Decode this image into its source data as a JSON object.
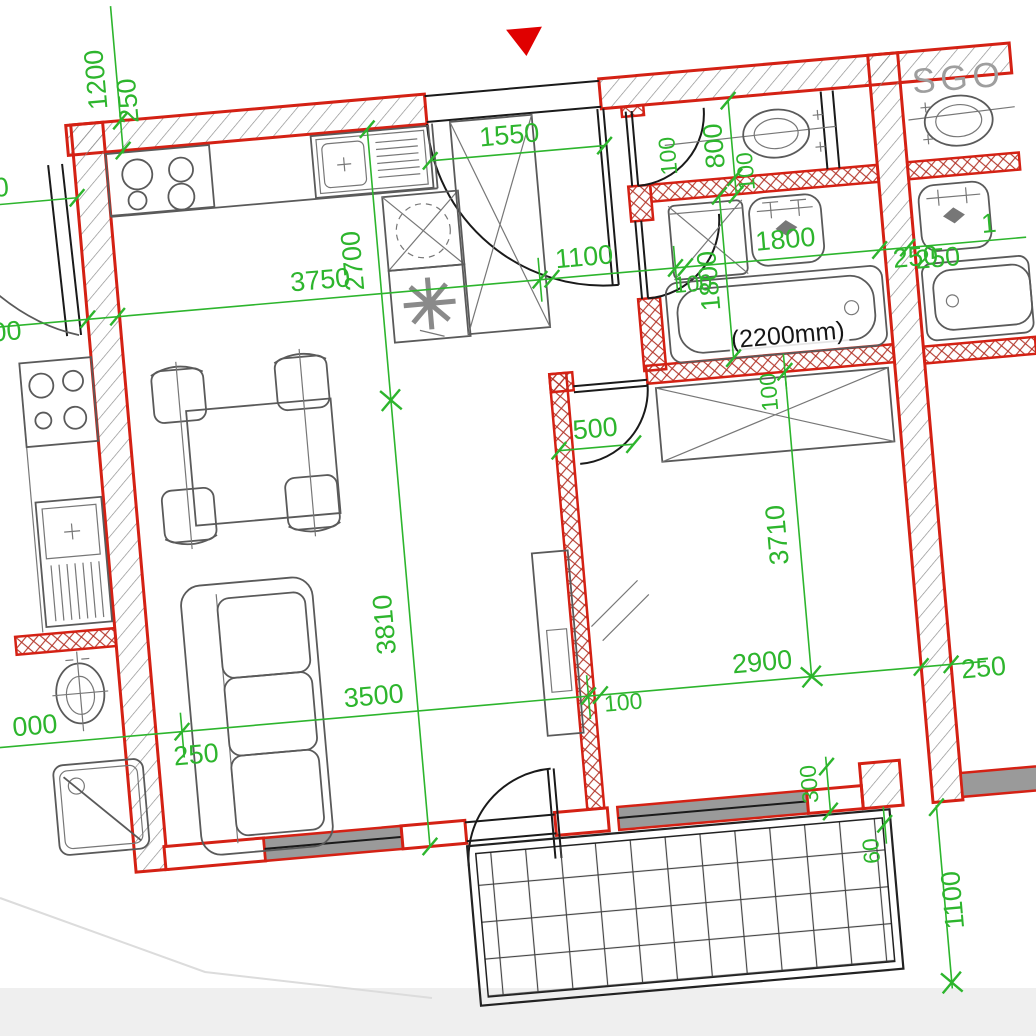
{
  "drawing_type": "apartment-floor-plan",
  "colors": {
    "wall_red": "#d42114",
    "dimension_green": "#2db52d",
    "fixture_grey": "#5a5a5a",
    "window_grey": "#9a9a9a",
    "entrance_marker_red": "#e00000",
    "neighbor_text_grey": "#9e9e9e",
    "outside_band_grey": "#efefef"
  },
  "annotations": {
    "sgo_label": "SGO",
    "bathtub_note": "(2200mm)"
  },
  "dims": {
    "v1200": "1200",
    "v250_tl": "250",
    "h3750": "3750",
    "v2700": "2700",
    "e1550": "1550",
    "h1100": "1100",
    "c100_hall": "100",
    "wc800": "800",
    "wc100_a": "100",
    "wc100_b": "100",
    "bath1800_v": "1800",
    "bath1800_h": "1800",
    "bath100": "100",
    "chain250_r": "250",
    "bed3710": "3710",
    "bed2900": "2900",
    "bed250": "250",
    "bed500": "500",
    "lv3810": "3810",
    "lv3500": "3500",
    "lv250": "250",
    "lv100": "100",
    "n1000": "000",
    "nl00_a": "00",
    "nl00_b": "00",
    "br300": "300",
    "br60": "60",
    "br1100": "1100",
    "nr250": "250",
    "nr1800_part": "1"
  }
}
